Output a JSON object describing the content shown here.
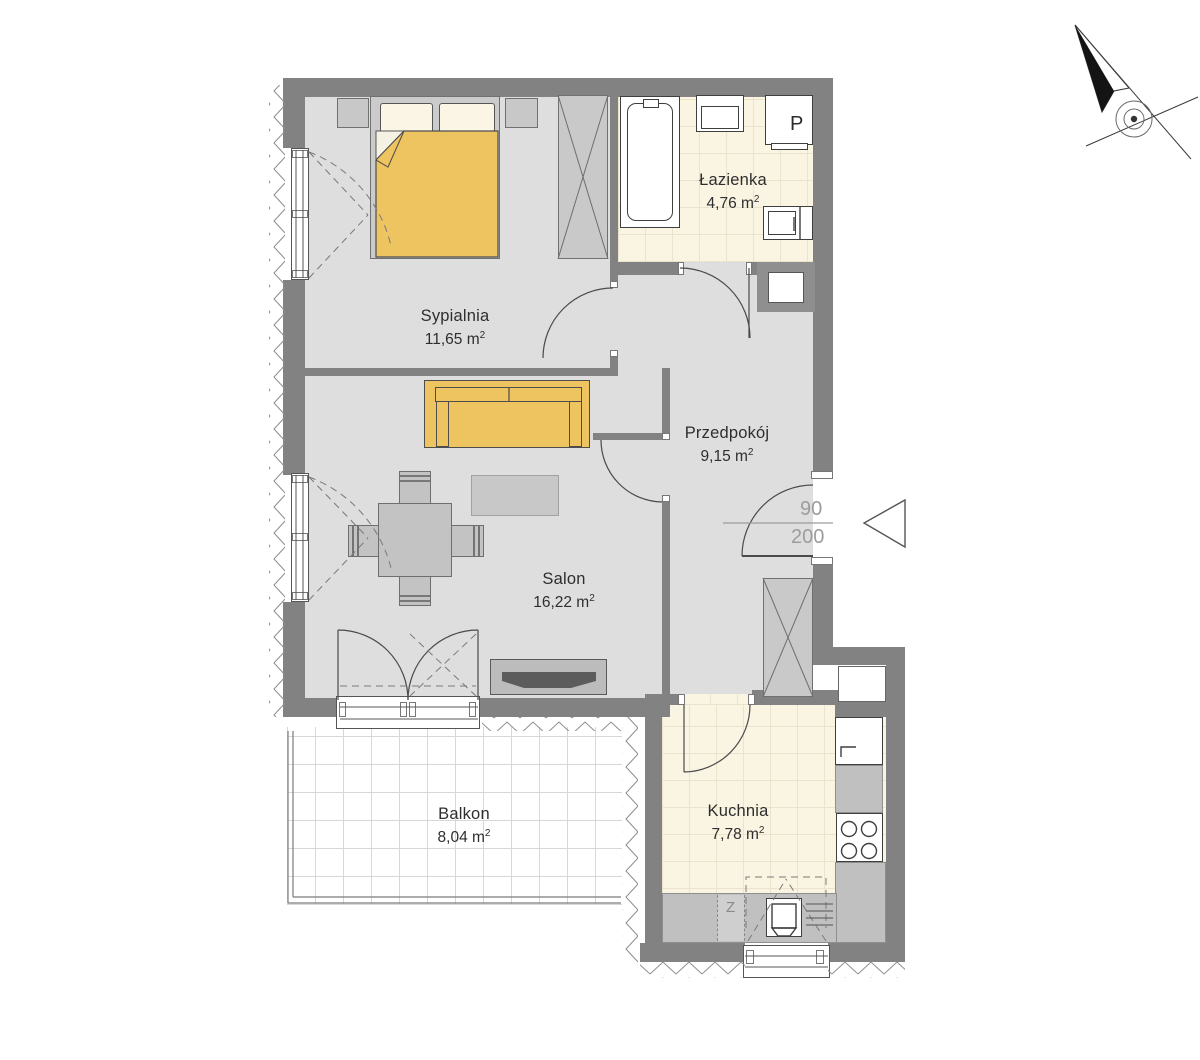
{
  "plan": {
    "title": "apartment-floor-plan",
    "rooms": [
      {
        "id": "sypialnia",
        "name": "Sypialnia",
        "area": "11,65 m",
        "area_sup": "2"
      },
      {
        "id": "lazienka",
        "name": "Łazienka",
        "area": "4,76 m",
        "area_sup": "2"
      },
      {
        "id": "przedpokoj",
        "name": "Przedpokój",
        "area": "9,15 m",
        "area_sup": "2"
      },
      {
        "id": "salon",
        "name": "Salon",
        "area": "16,22 m",
        "area_sup": "2"
      },
      {
        "id": "balkon",
        "name": "Balkon",
        "area": "8,04 m",
        "area_sup": "2"
      },
      {
        "id": "kuchnia",
        "name": "Kuchnia",
        "area": "7,78 m",
        "area_sup": "2"
      }
    ],
    "entry_door": {
      "width_cm": "90",
      "height_cm": "200"
    },
    "labels": {
      "washing_machine": "P",
      "kitchen_sink_unit": "Z"
    },
    "icons": {
      "compass": "north-arrow-compass",
      "entry_arrow": "entry-direction-arrow"
    },
    "colors": {
      "wall": "#828282",
      "floor": "#dedede",
      "tile_floor": "#faf4e2",
      "balcony_floor": "#ffffff",
      "accent_furniture": "#edc45f",
      "furniture_gray": "#c8c8c8",
      "line": "#4a4a4a",
      "dim_text": "#9c9c9c"
    }
  }
}
